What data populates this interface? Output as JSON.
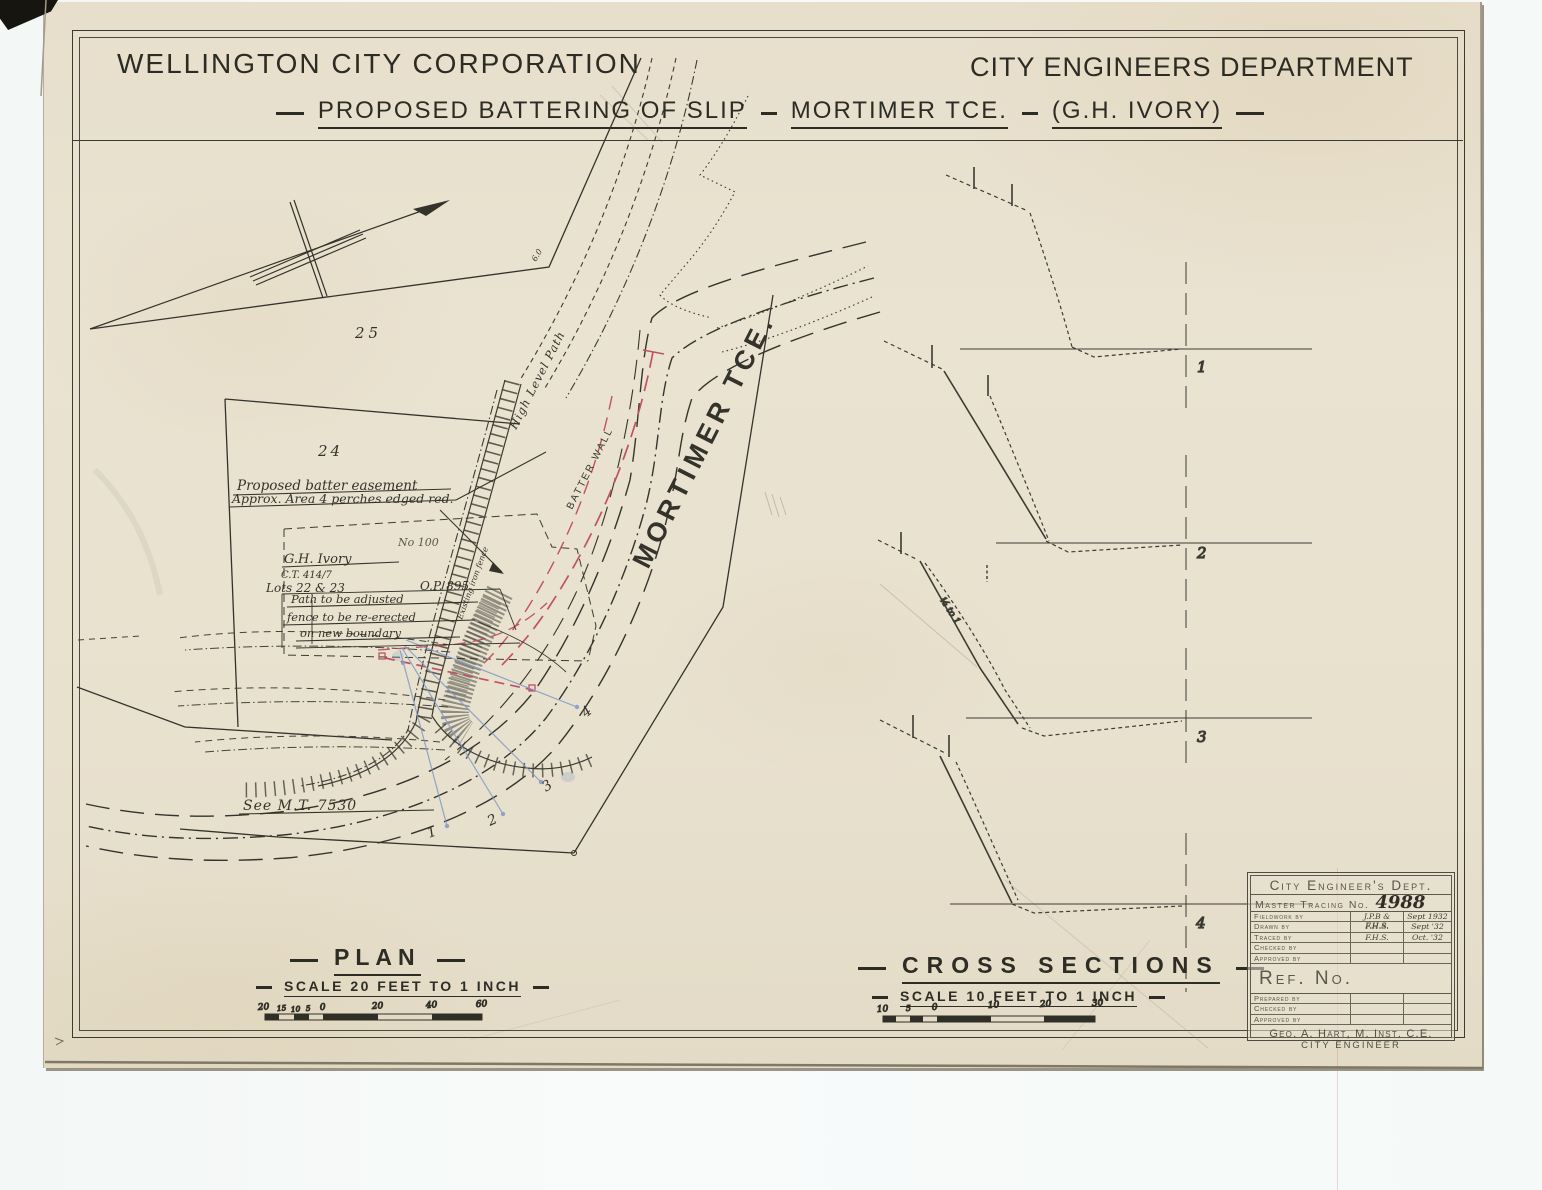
{
  "header": {
    "org": "WELLINGTON CITY CORPORATION",
    "dept": "CITY ENGINEERS DEPARTMENT",
    "title_part1": "PROPOSED BATTERING OF SLIP",
    "title_part2": "MORTIMER TCE.",
    "title_part3": "(G.H. IVORY)"
  },
  "plan": {
    "title": "PLAN",
    "scale_label": "SCALE 20 FEET TO 1 INCH",
    "scale_ticks": [
      "20",
      "15",
      "10",
      "5",
      "0",
      "20",
      "40",
      "60"
    ],
    "lot_upper": "25",
    "lot_lower": "24",
    "easement_note_1": "Proposed batter easement",
    "easement_note_2": "Approx. Area 4 perches edged red.",
    "owner_name": "G.H. Ivory",
    "owner_ct": "C.T. 414/7",
    "lots_label": "Lots 22 & 23",
    "dp_label": "O.P. 895.",
    "pencil_note": "No 100",
    "path_note_1": "Path to be adjusted",
    "path_note_2": "fence to be re-erected",
    "path_note_3": "on new boundary",
    "see_note": "See M.T. 7530",
    "street_name": "MORTIMER TCE.",
    "high_level_path": "High Level Path",
    "batter_wall": "BATTER WALL",
    "existing_fence": "Existing iron fence",
    "bend_value": "6.0",
    "markers": [
      "1",
      "2",
      "3",
      "4"
    ]
  },
  "sections": {
    "title": "CROSS SECTIONS",
    "scale_label": "SCALE 10 FEET TO 1 INCH",
    "scale_ticks": [
      "10",
      "5",
      "0",
      "10",
      "20",
      "30"
    ],
    "numbers": [
      "1",
      "2",
      "3",
      "4"
    ],
    "slope_note": "½ to 1"
  },
  "title_block": {
    "dept": "City Engineer's Dept.",
    "tracing_label": "Master Tracing No.",
    "tracing_number": "4988",
    "ref_label": "Ref. No.",
    "upper_rows": [
      {
        "label": "Fieldwork by",
        "value": "J.P.B & F.H.S.",
        "date": "Sept 1932"
      },
      {
        "label": "Drawn by",
        "value": "F.H.S.",
        "date": "Sept '32"
      },
      {
        "label": "Traced by",
        "value": "F.H.S.",
        "date": "Oct. '32"
      },
      {
        "label": "Checked by",
        "value": "",
        "date": ""
      },
      {
        "label": "Approved by",
        "value": "",
        "date": ""
      }
    ],
    "lower_rows": [
      {
        "label": "Prepared by"
      },
      {
        "label": "Checked by"
      },
      {
        "label": "Approved by"
      }
    ],
    "engineer_name": "Geo. A. Hart, M. Inst. C.E.",
    "engineer_title": "CITY ENGINEER"
  },
  "colors": {
    "paper": "#e9e2cf",
    "ink": "#34332b",
    "red_easement": "#c05266",
    "blue_sections": "#7e98c6",
    "pencil": "#8f897c"
  }
}
